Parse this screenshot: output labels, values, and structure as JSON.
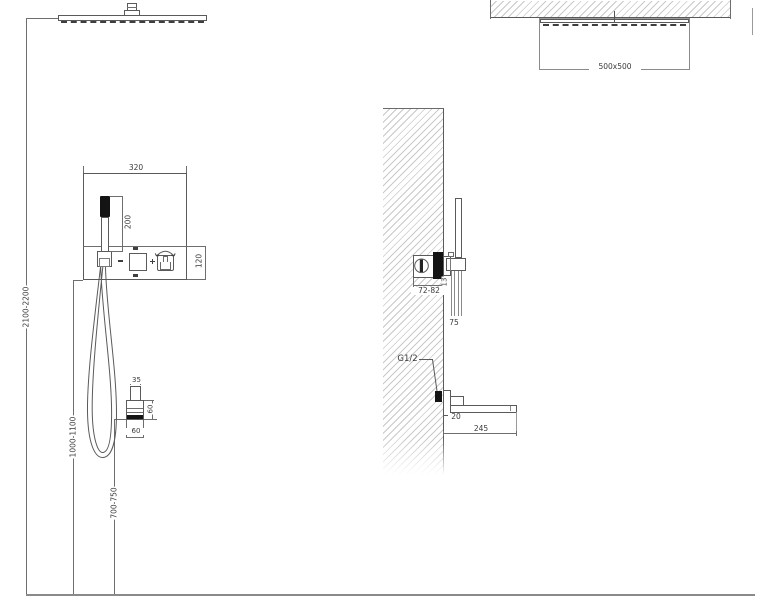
{
  "colors": {
    "line": "#5a5a5a",
    "hatch": "#c9c9c9",
    "fill_dark": "#141414",
    "background": "#ffffff"
  },
  "front_view": {
    "dims": {
      "total_height": "2100-2200",
      "mixer_height": "1000-1100",
      "spout_height": "700-750",
      "panel_width": "320",
      "hand_shower_length": "200",
      "panel_strip_height": "120",
      "spout_width_top": "35",
      "spout_height_side": "60",
      "spout_width_bottom": "60"
    }
  },
  "side_view": {
    "dims": {
      "head_size": "500x500",
      "valve_depth_range": "72-82",
      "trim_thickness": "13",
      "holder_length": "75",
      "spout_drop": "20",
      "spout_length": "245"
    },
    "labels": {
      "inlet_thread": "G1/2"
    }
  }
}
